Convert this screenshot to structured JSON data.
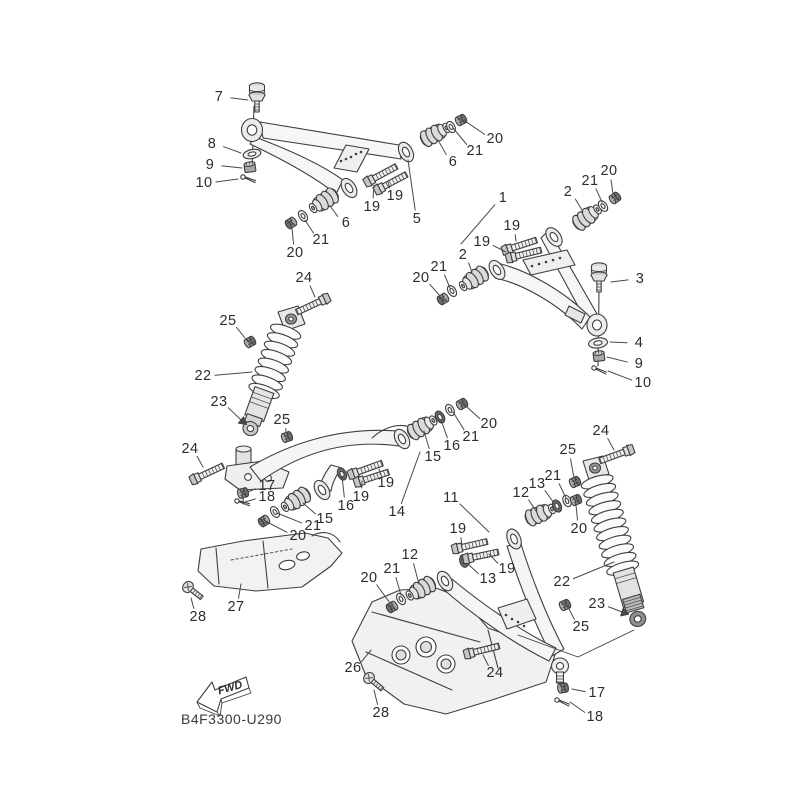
{
  "diagram": {
    "code": "B4F3300-U290",
    "direction_marker": "FWD",
    "background": "#ffffff",
    "line_color": "#3f3f3f",
    "text_color": "#2d2d2d",
    "callouts": [
      {
        "label": "7",
        "x": 219,
        "y": 97,
        "tx": 248,
        "ty": 100
      },
      {
        "label": "8",
        "x": 212,
        "y": 144,
        "tx": 241,
        "ty": 153
      },
      {
        "label": "9",
        "x": 210,
        "y": 165,
        "tx": 242,
        "ty": 168
      },
      {
        "label": "10",
        "x": 204,
        "y": 183,
        "tx": 238,
        "ty": 179
      },
      {
        "label": "20",
        "x": 495,
        "y": 139,
        "tx": 465,
        "ty": 121
      },
      {
        "label": "21",
        "x": 475,
        "y": 151,
        "tx": 453,
        "ty": 128
      },
      {
        "label": "6",
        "x": 453,
        "y": 162,
        "tx": 438,
        "ty": 140
      },
      {
        "label": "20",
        "x": 609,
        "y": 171,
        "tx": 613,
        "ty": 194
      },
      {
        "label": "21",
        "x": 590,
        "y": 181,
        "tx": 602,
        "ty": 202
      },
      {
        "label": "2",
        "x": 568,
        "y": 192,
        "tx": 582,
        "ty": 210
      },
      {
        "label": "19",
        "x": 395,
        "y": 196,
        "tx": 388,
        "ty": 182
      },
      {
        "label": "1",
        "x": 503,
        "y": 198,
        "tx": 461,
        "ty": 244
      },
      {
        "label": "19",
        "x": 372,
        "y": 207,
        "tx": 374,
        "ty": 185
      },
      {
        "label": "5",
        "x": 417,
        "y": 219,
        "tx": 408,
        "ty": 160
      },
      {
        "label": "6",
        "x": 346,
        "y": 223,
        "tx": 330,
        "ty": 206
      },
      {
        "label": "19",
        "x": 512,
        "y": 226,
        "tx": 516,
        "ty": 241
      },
      {
        "label": "21",
        "x": 321,
        "y": 240,
        "tx": 305,
        "ty": 220
      },
      {
        "label": "19",
        "x": 482,
        "y": 242,
        "tx": 506,
        "ty": 252
      },
      {
        "label": "20",
        "x": 295,
        "y": 253,
        "tx": 292,
        "ty": 228
      },
      {
        "label": "2",
        "x": 463,
        "y": 255,
        "tx": 472,
        "ty": 272
      },
      {
        "label": "21",
        "x": 439,
        "y": 267,
        "tx": 450,
        "ty": 288
      },
      {
        "label": "20",
        "x": 421,
        "y": 278,
        "tx": 440,
        "ty": 296
      },
      {
        "label": "24",
        "x": 304,
        "y": 278,
        "tx": 315,
        "ty": 297
      },
      {
        "label": "3",
        "x": 640,
        "y": 279,
        "tx": 611,
        "ty": 282
      },
      {
        "label": "25",
        "x": 228,
        "y": 321,
        "tx": 245,
        "ty": 338
      },
      {
        "label": "4",
        "x": 639,
        "y": 343,
        "tx": 610,
        "ty": 342
      },
      {
        "label": "9",
        "x": 639,
        "y": 364,
        "tx": 607,
        "ty": 357
      },
      {
        "label": "22",
        "x": 203,
        "y": 376,
        "tx": 252,
        "ty": 372
      },
      {
        "label": "10",
        "x": 643,
        "y": 383,
        "tx": 608,
        "ty": 371
      },
      {
        "label": "23",
        "x": 219,
        "y": 402,
        "tx": 241,
        "ty": 420,
        "tri": true
      },
      {
        "label": "25",
        "x": 282,
        "y": 420,
        "tx": 286,
        "ty": 432
      },
      {
        "label": "20",
        "x": 489,
        "y": 424,
        "tx": 466,
        "ty": 406
      },
      {
        "label": "24",
        "x": 601,
        "y": 431,
        "tx": 614,
        "ty": 450
      },
      {
        "label": "21",
        "x": 471,
        "y": 437,
        "tx": 453,
        "ty": 412
      },
      {
        "label": "16",
        "x": 452,
        "y": 446,
        "tx": 441,
        "ty": 420
      },
      {
        "label": "24",
        "x": 190,
        "y": 449,
        "tx": 203,
        "ty": 467
      },
      {
        "label": "25",
        "x": 568,
        "y": 450,
        "tx": 574,
        "ty": 478
      },
      {
        "label": "15",
        "x": 433,
        "y": 457,
        "tx": 424,
        "ty": 431
      },
      {
        "label": "21",
        "x": 553,
        "y": 476,
        "tx": 566,
        "ty": 498
      },
      {
        "label": "13",
        "x": 537,
        "y": 484,
        "tx": 554,
        "ty": 503
      },
      {
        "label": "19",
        "x": 386,
        "y": 483,
        "tx": 379,
        "ty": 469
      },
      {
        "label": "17",
        "x": 267,
        "y": 486,
        "tx": 248,
        "ty": 492
      },
      {
        "label": "12",
        "x": 521,
        "y": 493,
        "tx": 536,
        "ty": 511
      },
      {
        "label": "18",
        "x": 267,
        "y": 497,
        "tx": 245,
        "ty": 502
      },
      {
        "label": "11",
        "x": 451,
        "y": 498,
        "tx": 489,
        "ty": 532
      },
      {
        "label": "19",
        "x": 361,
        "y": 497,
        "tx": 362,
        "ty": 481
      },
      {
        "label": "16",
        "x": 346,
        "y": 506,
        "tx": 342,
        "ty": 477
      },
      {
        "label": "14",
        "x": 397,
        "y": 512,
        "tx": 420,
        "ty": 452
      },
      {
        "label": "15",
        "x": 325,
        "y": 519,
        "tx": 303,
        "ty": 503
      },
      {
        "label": "21",
        "x": 313,
        "y": 526,
        "tx": 277,
        "ty": 513
      },
      {
        "label": "19",
        "x": 458,
        "y": 529,
        "tx": 462,
        "ty": 545
      },
      {
        "label": "20",
        "x": 579,
        "y": 529,
        "tx": 576,
        "ty": 505
      },
      {
        "label": "20",
        "x": 298,
        "y": 536,
        "tx": 267,
        "ty": 522
      },
      {
        "label": "12",
        "x": 410,
        "y": 555,
        "tx": 419,
        "ty": 584
      },
      {
        "label": "21",
        "x": 392,
        "y": 569,
        "tx": 401,
        "ty": 595
      },
      {
        "label": "19",
        "x": 507,
        "y": 569,
        "tx": 489,
        "ty": 554
      },
      {
        "label": "20",
        "x": 369,
        "y": 578,
        "tx": 390,
        "ty": 603
      },
      {
        "label": "13",
        "x": 488,
        "y": 579,
        "tx": 468,
        "ty": 564
      },
      {
        "label": "22",
        "x": 562,
        "y": 582,
        "tx": 614,
        "ty": 562
      },
      {
        "label": "23",
        "x": 597,
        "y": 604,
        "tx": 622,
        "ty": 612,
        "tri": true
      },
      {
        "label": "27",
        "x": 236,
        "y": 607,
        "tx": 241,
        "ty": 584
      },
      {
        "label": "28",
        "x": 198,
        "y": 617,
        "tx": 191,
        "ty": 598
      },
      {
        "label": "25",
        "x": 581,
        "y": 627,
        "tx": 568,
        "ty": 607
      },
      {
        "label": "26",
        "x": 353,
        "y": 668,
        "tx": 371,
        "ty": 650
      },
      {
        "label": "24",
        "x": 495,
        "y": 673,
        "tx": 483,
        "ty": 655
      },
      {
        "label": "17",
        "x": 597,
        "y": 693,
        "tx": 572,
        "ty": 689
      },
      {
        "label": "28",
        "x": 381,
        "y": 713,
        "tx": 374,
        "ty": 690
      },
      {
        "label": "18",
        "x": 595,
        "y": 717,
        "tx": 570,
        "ty": 702
      }
    ]
  }
}
